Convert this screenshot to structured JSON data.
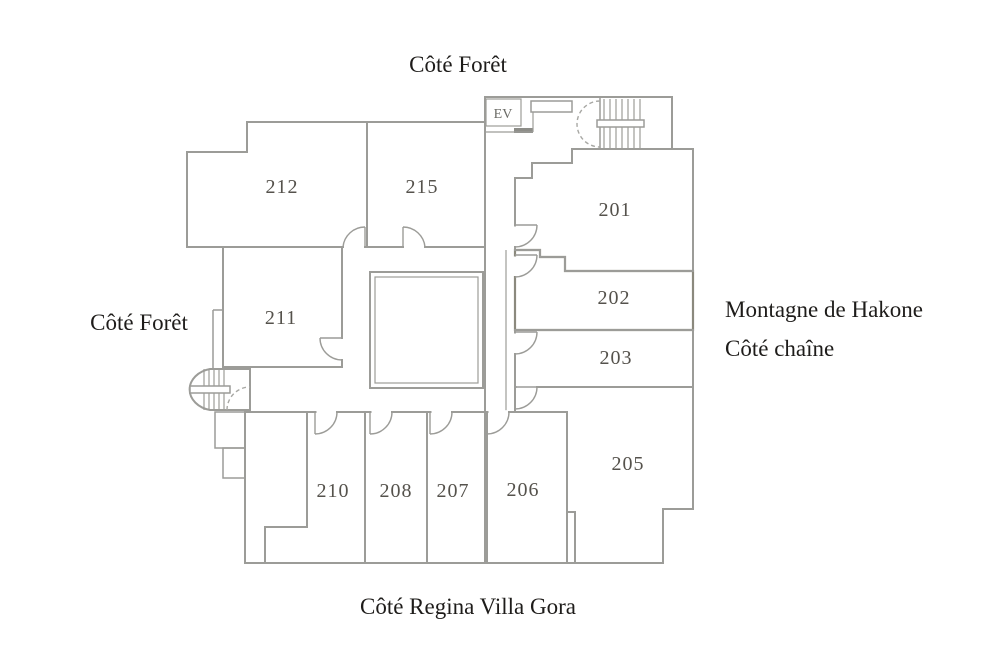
{
  "labels": {
    "top": "Côté Forêt",
    "left": "Côté Forêt",
    "right_line1": "Montagne de Hakone",
    "right_line2": "Côté chaîne",
    "bottom": "Côté Regina Villa Gora",
    "elevator": "EV"
  },
  "rooms": {
    "r212": {
      "number": "212",
      "highlighted": false
    },
    "r215": {
      "number": "215",
      "highlighted": false
    },
    "r201": {
      "number": "201",
      "highlighted": false
    },
    "r211": {
      "number": "211",
      "highlighted": false
    },
    "r202": {
      "number": "202",
      "highlighted": true
    },
    "r203": {
      "number": "203",
      "highlighted": false
    },
    "r205": {
      "number": "205",
      "highlighted": false
    },
    "r210": {
      "number": "210",
      "highlighted": false
    },
    "r208": {
      "number": "208",
      "highlighted": false
    },
    "r207": {
      "number": "207",
      "highlighted": false
    },
    "r206": {
      "number": "206",
      "highlighted": false
    }
  },
  "colors": {
    "wall": "#9c9c98",
    "highlight_fill": "#e9e6cf",
    "highlight_stroke": "#8b897d",
    "side_label_text": "#1e1c1a",
    "room_number_text": "#55524c"
  }
}
